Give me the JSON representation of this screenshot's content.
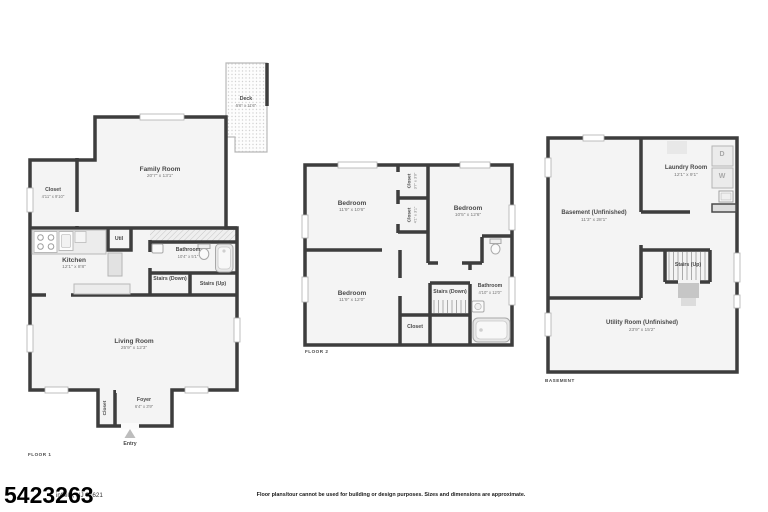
{
  "colors": {
    "wall": "#3d3d3d",
    "floor_fill": "#f4f4f4",
    "deck_dot": "#d2d2d2",
    "text": "#4a4a4a"
  },
  "floor1": {
    "floor_label": "FLOOR 1",
    "family_room": {
      "name": "Family Room",
      "dims": "20'7\" x 13'1\""
    },
    "deck": {
      "name": "Deck",
      "dims": "5'6\" x 11'6\""
    },
    "closet": {
      "name": "Closet",
      "dims": "4'11\" x 9'10\""
    },
    "kitchen": {
      "name": "Kitchen",
      "dims": "12'1\" x 8'8\""
    },
    "util": {
      "name": "Util"
    },
    "bathroom": {
      "name": "Bathroom",
      "dims": "10'4\" x 5'1\""
    },
    "stairs_down": {
      "name": "Stairs (Down)"
    },
    "stairs_up": {
      "name": "Stairs (Up)"
    },
    "living_room": {
      "name": "Living Room",
      "dims": "25'9\" x 12'3\""
    },
    "foyer": {
      "name": "Foyer",
      "dims": "6'4\" x 3'9\""
    },
    "foyer_closet": {
      "name": "Closet"
    },
    "entry": {
      "name": "Entry"
    }
  },
  "floor2": {
    "floor_label": "FLOOR 2",
    "bedroom_top_left": {
      "name": "Bedroom",
      "dims": "11'9\" x 10'6\""
    },
    "bedroom_right": {
      "name": "Bedroom",
      "dims": "10'5\" x 12'6\""
    },
    "bedroom_bottom_left": {
      "name": "Bedroom",
      "dims": "11'9\" x 12'0\""
    },
    "closet_top": {
      "name": "Closet",
      "dims": "3'7\" x 3'0\""
    },
    "closet_mid": {
      "name": "Closet",
      "dims": "4'1\" x 3'1\""
    },
    "closet_bottom": {
      "name": "Closet"
    },
    "stairs_down": {
      "name": "Stairs (Down)"
    },
    "bathroom": {
      "name": "Bathroom",
      "dims": "4'10\" x 12'0\""
    }
  },
  "basement": {
    "floor_label": "BASEMENT",
    "basement_room": {
      "name": "Basement (Unfinished)",
      "dims": "11'3\" x 28'1\""
    },
    "laundry_room": {
      "name": "Laundry Room",
      "dims": "12'1\" x 9'1\""
    },
    "stairs_up": {
      "name": "Stairs (Up)"
    },
    "utility_room": {
      "name": "Utility Room (Unfinished)",
      "dims": "23'9\" x 15'2\""
    },
    "dryer_label": "D",
    "washer_label": "W"
  },
  "footer": {
    "listing_number": "5423263",
    "address_visible": "infield, NJ 07621",
    "disclaimer": "Floor plans/tour cannot be used for building or design purposes. Sizes and dimensions are approximate."
  }
}
